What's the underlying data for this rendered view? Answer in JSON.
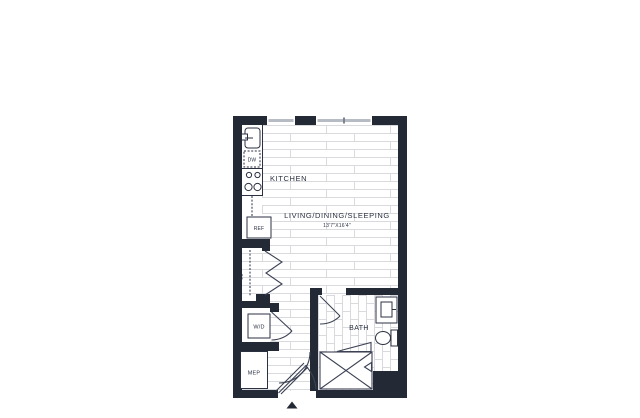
{
  "colors": {
    "wall": "#242936",
    "line": "#2b3140",
    "floor_line": "#d8dade",
    "glass": "#b7bbc4",
    "background": "#ffffff"
  },
  "floor_plan": {
    "rooms": {
      "kitchen": {
        "label": "KITCHEN"
      },
      "living_dining_sleeping": {
        "label": "LIVING/DINING/SLEEPING",
        "dimensions": "13'7\"X16'4\""
      },
      "bath": {
        "label": "BATH"
      },
      "closet": {
        "label": "CL"
      },
      "laundry": {
        "label": "W/D"
      },
      "mep": {
        "label": "MEP"
      }
    },
    "appliances": {
      "dishwasher": {
        "label": "DW"
      },
      "refrigerator": {
        "label": "REF"
      }
    }
  }
}
